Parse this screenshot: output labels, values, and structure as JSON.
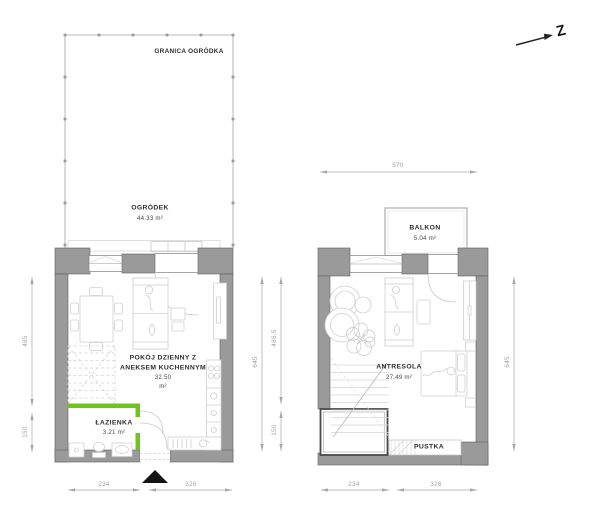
{
  "meta": {
    "drawing_type": "apartment floor plan, two levels",
    "language": "pl"
  },
  "compass": {
    "label": "Z"
  },
  "garden": {
    "boundary_label": "GRANICA OGRÓDKA",
    "name": "OGRÓDEK",
    "area": "44.33 m²"
  },
  "ground_floor": {
    "living_room": {
      "name_line1": "POKÓJ DZIENNY Z",
      "name_line2": "ANEKSEM KUCHENNYM",
      "area_value": "32.50",
      "area_unit": "m²"
    },
    "bathroom": {
      "name": "ŁAZIENKA",
      "area": "3.21 m²"
    },
    "dimensions": {
      "side_upper": "485",
      "side_lower": "150",
      "right_total": "645",
      "right_upper": "486.5",
      "right_lower": "150",
      "bottom_left": "234",
      "bottom_right": "326"
    }
  },
  "mezzanine": {
    "name": "ANTRESOLA",
    "area": "27.49 m²",
    "balcony": {
      "name": "BALKON",
      "area": "5.04 m²"
    },
    "void_label": "PUSTKA",
    "dimensions": {
      "top": "570",
      "right": "645",
      "bottom_left": "234",
      "bottom_right": "326"
    }
  },
  "colors": {
    "wall_fill": "#9a9a9a",
    "wall_edge": "#5f5f5f",
    "accent_green": "#6fc41c",
    "furniture_line": "#cfcfcf",
    "dimension_line": "#a8a8a8",
    "entrance_marker": "#141414"
  }
}
